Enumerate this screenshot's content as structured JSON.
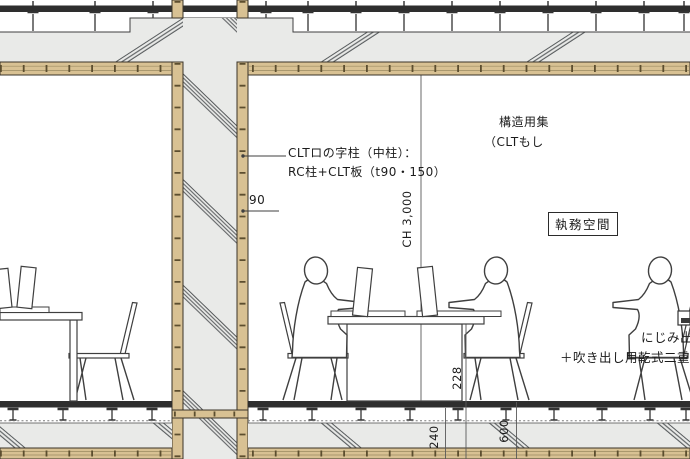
{
  "drawing": {
    "labels": {
      "clt_column_note_line1": "CLTロの字柱（中柱）：",
      "clt_column_note_line2": "RC柱+CLT板（t90・150）",
      "material_note_line1": "構造用集",
      "material_note_line2": "（CLTもし",
      "room_name": "執務空間",
      "bottom_note_line1": "にじみ出",
      "bottom_note_line2": "＋吹き出し用乾式二重"
    },
    "dimensions": {
      "ceiling_height": "CH 3,000",
      "panel_thickness": "90",
      "dim_a": "228",
      "dim_b": "240",
      "dim_c": "600"
    },
    "colors": {
      "wood": "#d8c193",
      "concrete_gray": "#e9eae8",
      "line_dark": "#2e2e2e"
    }
  }
}
